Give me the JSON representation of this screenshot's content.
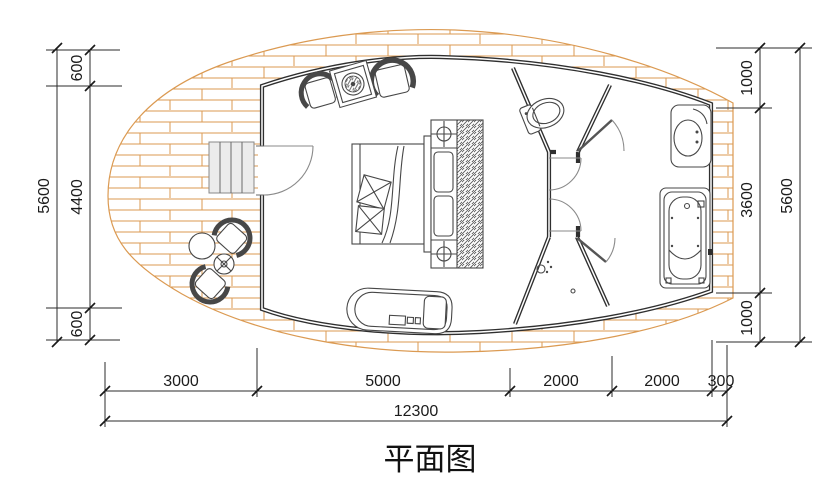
{
  "title": "平面图",
  "dimensions": {
    "left": {
      "segments": [
        "600",
        "4400",
        "600"
      ],
      "total": "5600"
    },
    "right": {
      "segments": [
        "1000",
        "3600",
        "1000"
      ],
      "total": "5600"
    },
    "bottom": {
      "segments": [
        "3000",
        "5000",
        "2000",
        "2000",
        "300"
      ],
      "total": "12300"
    }
  },
  "colors": {
    "deck": "#DB9A52",
    "wall": "#2F2F2F",
    "dimension": "#2B2B2B",
    "stairs_fill": "#ECECEC",
    "background": "#FFFFFF"
  },
  "fixture_icons": [
    "deck-icon",
    "stairs-icon",
    "entrance-door-icon",
    "double-bed-icon",
    "nightstand-lamp-icon",
    "wardrobe-icon",
    "armchair-icon",
    "coffee-table-icon",
    "sofa-bench-icon",
    "outdoor-chair-icon",
    "outdoor-table-icon",
    "parasol-base-icon",
    "toilet-icon",
    "shower-icon",
    "washbasin-icon",
    "bathtub-icon",
    "interior-door-icon"
  ]
}
